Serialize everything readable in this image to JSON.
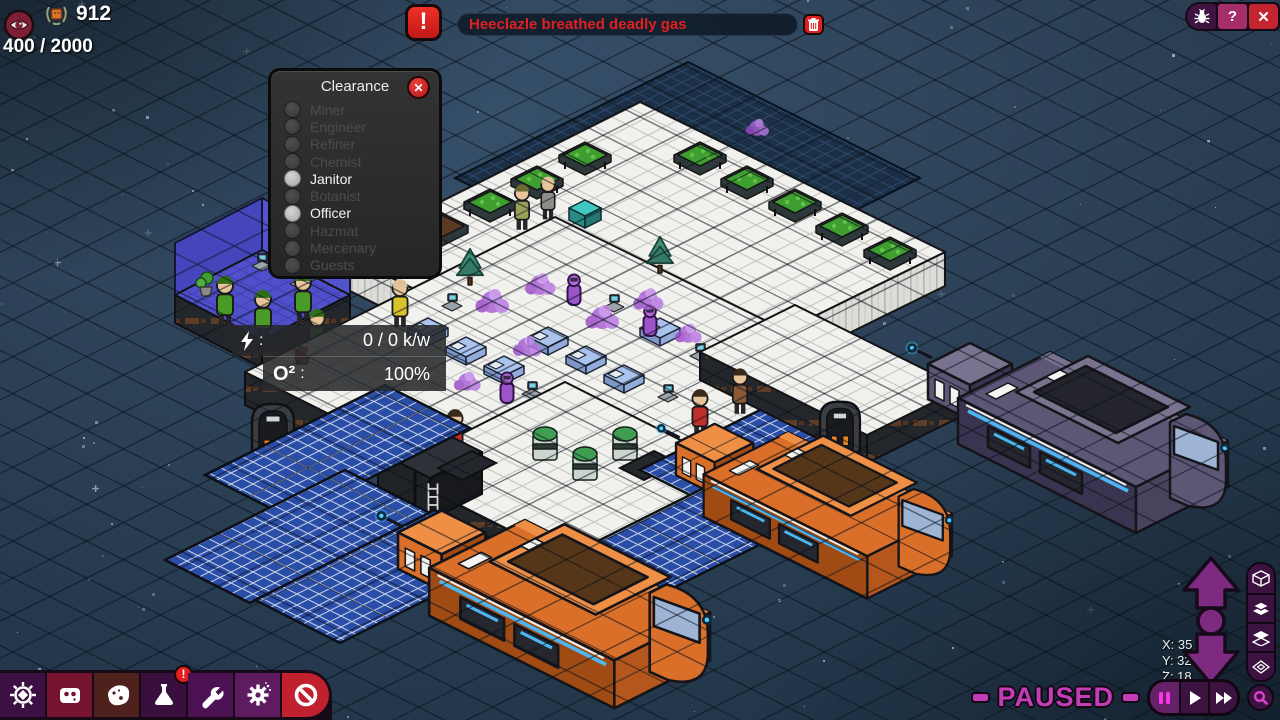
{
  "hud": {
    "medals_count": "912",
    "capacity": "400 / 2000"
  },
  "alert": {
    "exclamation": "!",
    "message": "Heeclazle breathed deadly gas"
  },
  "window_controls": {
    "help_label": "?",
    "close_label": "✕"
  },
  "clearance": {
    "title": "Clearance",
    "close_label": "✕",
    "items": [
      {
        "label": "Miner",
        "enabled": false
      },
      {
        "label": "Engineer",
        "enabled": false
      },
      {
        "label": "Refiner",
        "enabled": false
      },
      {
        "label": "Chemist",
        "enabled": false
      },
      {
        "label": "Janitor",
        "enabled": true
      },
      {
        "label": "Botanist",
        "enabled": false
      },
      {
        "label": "Officer",
        "enabled": true
      },
      {
        "label": "Hazmat",
        "enabled": false
      },
      {
        "label": "Mercenary",
        "enabled": false
      },
      {
        "label": "Guests",
        "enabled": false
      }
    ]
  },
  "status_tooltip": {
    "power_icon": "lightning-icon",
    "colon": ":",
    "power_value": "0 / 0 k/w",
    "oxygen_label": "O²",
    "oxygen_value": "100%"
  },
  "toolbar": {
    "buttons": [
      {
        "name": "helm",
        "icon": "helm-icon",
        "color": "#3c1043"
      },
      {
        "name": "robot",
        "icon": "robot-icon",
        "color": "#76132f"
      },
      {
        "name": "asteroid",
        "icon": "asteroid-icon",
        "color": "#4e211c"
      },
      {
        "name": "flask",
        "icon": "flask-icon",
        "color": "#390f3d",
        "badge": "!"
      },
      {
        "name": "wrench",
        "icon": "wrench-icon",
        "color": "#4b1152"
      },
      {
        "name": "gear",
        "icon": "gear-particles-icon",
        "color": "#5e1b60"
      },
      {
        "name": "prohibition",
        "icon": "prohibition-icon",
        "color": "#c1202f"
      }
    ]
  },
  "coordinates": {
    "x": "X: 35",
    "y": "Y: 32",
    "z": "Z: 18"
  },
  "playback": {
    "paused_label": "PAUSED"
  },
  "view_controls": {
    "icons": [
      "cube-wireframe-icon",
      "layers-stack-icon",
      "layers-single-icon",
      "layer-frame-icon"
    ]
  },
  "colors": {
    "accent_magenta": "#c33db6",
    "alert_red": "#e22620",
    "pill_purple": "#3c1340",
    "help_magenta": "#a52e6a",
    "close_red": "#c22430"
  }
}
